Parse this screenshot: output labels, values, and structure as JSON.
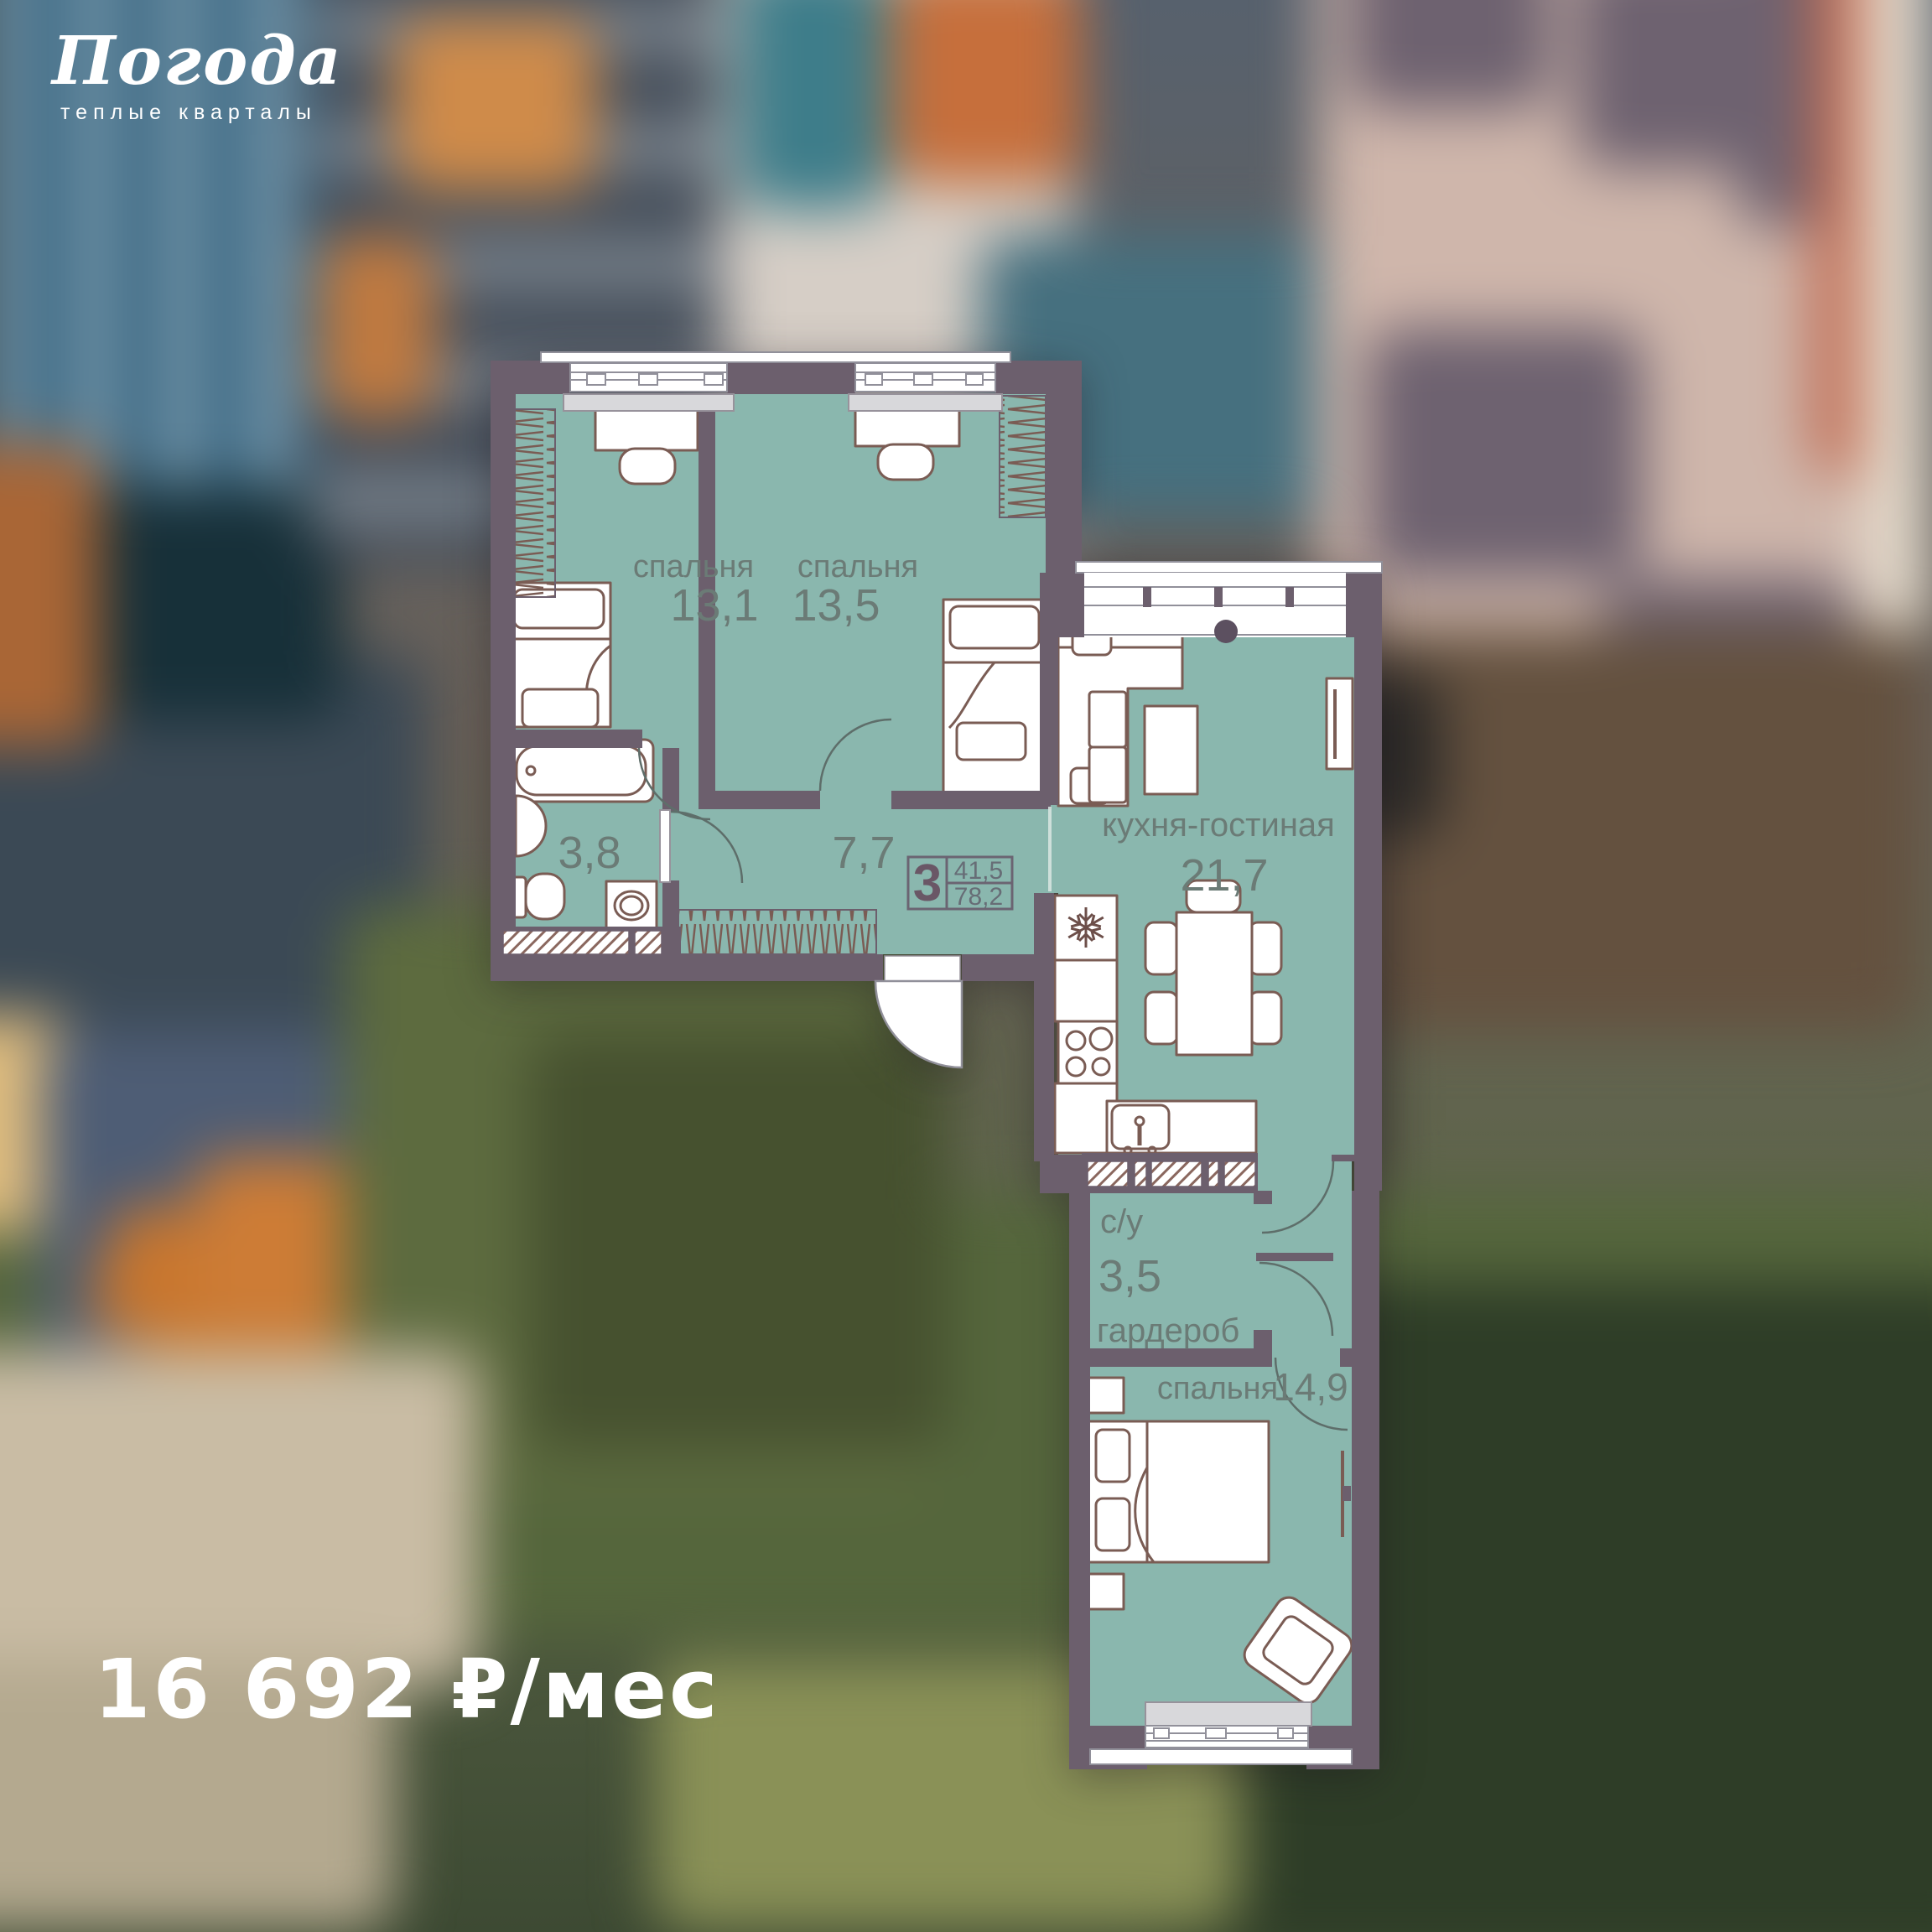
{
  "brand": {
    "name": "Погода",
    "tagline": "теплые кварталы"
  },
  "price": {
    "label": "16 692 ₽/мес"
  },
  "plan": {
    "badge": {
      "rooms": "3",
      "living_area": "41,5",
      "total_area": "78,2"
    },
    "rooms": {
      "bedroom1": {
        "label": "спальня",
        "area": "13,1"
      },
      "bedroom2": {
        "label": "спальня",
        "area": "13,5"
      },
      "kitchen_living": {
        "label": "кухня-гостиная",
        "area": "21,7"
      },
      "bathroom": {
        "area": "3,8"
      },
      "hallway": {
        "area": "7,7"
      },
      "wc": {
        "label": "с/у",
        "area": "3,5"
      },
      "wardrobe": {
        "label": "гардероб"
      },
      "bedroom3": {
        "label": "спальня",
        "area": "14,9"
      }
    }
  }
}
